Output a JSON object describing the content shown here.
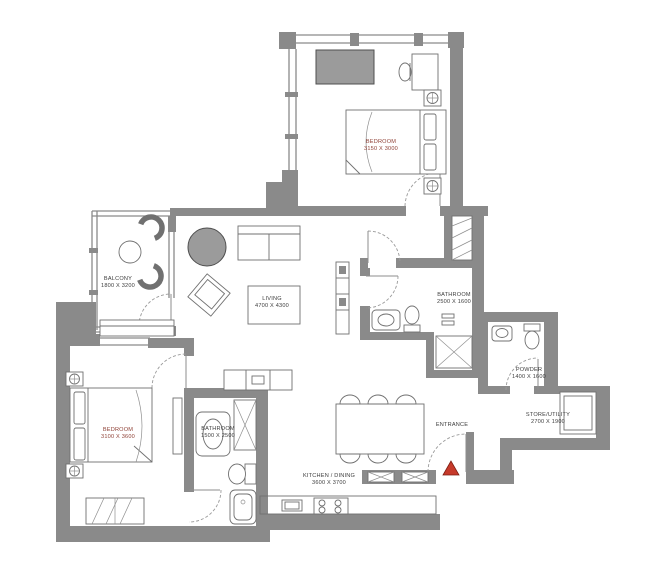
{
  "plan": {
    "rooms": {
      "balcony": {
        "name": "BALCONY",
        "dims": "1800 X 3200"
      },
      "living": {
        "name": "LIVING",
        "dims": "4700 X 4300"
      },
      "bedroom_top": {
        "name": "BEDROOM",
        "dims": "3150 X 3000"
      },
      "bathroom_top": {
        "name": "BATHROOM",
        "dims": "2500 X 1600"
      },
      "powder": {
        "name": "POWDER",
        "dims": "1400 X 1600"
      },
      "store": {
        "name": "STORE/UTILITY",
        "dims": "2700 X 1900"
      },
      "bedroom_left": {
        "name": "BEDROOM",
        "dims": "3100 X 3600"
      },
      "bathroom_left": {
        "name": "BATHROOM",
        "dims": "1500 X 2500"
      },
      "kitchen": {
        "name": "KITCHEN / DINING",
        "dims": "3600 X 3700"
      },
      "entrance": {
        "name": "ENTRANCE"
      }
    },
    "colors": {
      "background": "#ffffff",
      "wall": "#8a8a8a",
      "furniture_gray": "#9b9b9b",
      "line": "#707070",
      "label": "#3d3d3d",
      "bedroom_label": "#8f4136",
      "entrance_marker": "#c63a2b"
    }
  }
}
